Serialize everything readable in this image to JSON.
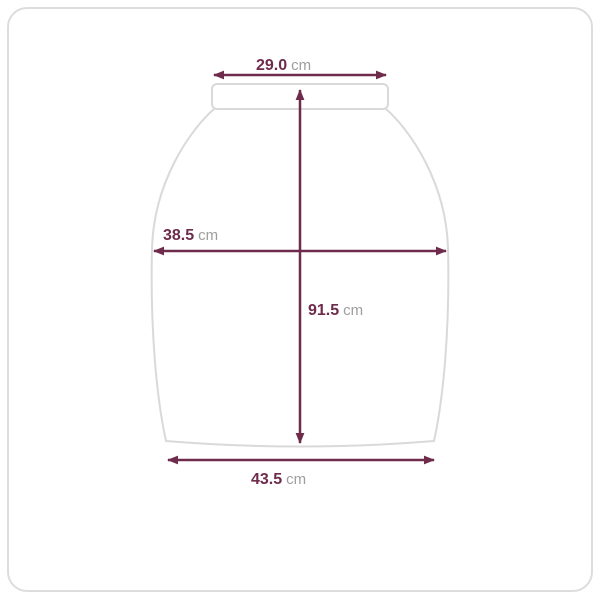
{
  "colors": {
    "measure_line": "#6e2b4b",
    "value_text": "#6e2b4b",
    "unit_text": "#9e9e9e",
    "garment_outline": "#d9d9d9",
    "frame_border": "#dddddd",
    "background": "#ffffff"
  },
  "measurements": {
    "top_width": {
      "value": "29.0",
      "unit": "cm"
    },
    "hip_width": {
      "value": "38.5",
      "unit": "cm"
    },
    "length": {
      "value": "91.5",
      "unit": "cm"
    },
    "hem_width": {
      "value": "43.5",
      "unit": "cm"
    }
  }
}
